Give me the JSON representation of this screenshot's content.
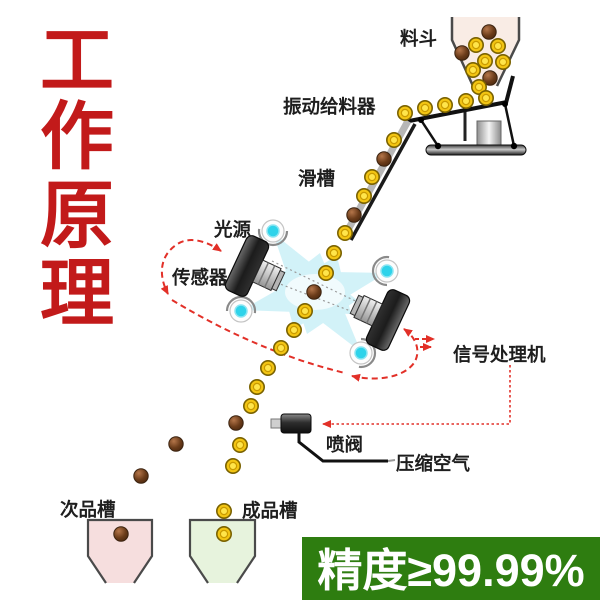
{
  "title": {
    "text": "工作原理",
    "chars": [
      "工",
      "作",
      "原",
      "理"
    ],
    "color": "#c21a1a"
  },
  "labels": {
    "hopper": "料斗",
    "feeder": "振动给料器",
    "chute": "滑槽",
    "light_source": "光源",
    "sensor": "传感器",
    "signal_processor": "信号处理机",
    "spray_valve": "喷阀",
    "compressed_air": "压缩空气",
    "reject_trough": "次品槽",
    "accept_trough": "成品槽"
  },
  "badge": {
    "text": "精度≥99.99%",
    "bg": "#2e7d10",
    "fg": "#ffffff"
  },
  "colors": {
    "accent_red": "#e23028",
    "title_red": "#c21a1a",
    "ball_yellow": "#f3c513",
    "ball_brown": "#6b3c1a",
    "beam_cyan": "#aee8f4",
    "hopper_fill": "#f9ece5",
    "reject_trough_fill": "#f6dede",
    "accept_trough_fill": "#e7f3dd"
  },
  "diagram": {
    "balls": [
      {
        "x": 489,
        "y": 32,
        "c": "b"
      },
      {
        "x": 476,
        "y": 45,
        "c": "y"
      },
      {
        "x": 498,
        "y": 46,
        "c": "y"
      },
      {
        "x": 462,
        "y": 53,
        "c": "b"
      },
      {
        "x": 485,
        "y": 61,
        "c": "y"
      },
      {
        "x": 503,
        "y": 62,
        "c": "y"
      },
      {
        "x": 473,
        "y": 70,
        "c": "y"
      },
      {
        "x": 490,
        "y": 78,
        "c": "b"
      },
      {
        "x": 479,
        "y": 87,
        "c": "y"
      },
      {
        "x": 486,
        "y": 98,
        "c": "y"
      },
      {
        "x": 466,
        "y": 101,
        "c": "y"
      },
      {
        "x": 445,
        "y": 105,
        "c": "y"
      },
      {
        "x": 425,
        "y": 108,
        "c": "y"
      },
      {
        "x": 405,
        "y": 113,
        "c": "y"
      },
      {
        "x": 394,
        "y": 140,
        "c": "y"
      },
      {
        "x": 384,
        "y": 159,
        "c": "b"
      },
      {
        "x": 372,
        "y": 177,
        "c": "y"
      },
      {
        "x": 364,
        "y": 196,
        "c": "y"
      },
      {
        "x": 354,
        "y": 215,
        "c": "b"
      },
      {
        "x": 345,
        "y": 233,
        "c": "y"
      },
      {
        "x": 334,
        "y": 253,
        "c": "y"
      },
      {
        "x": 326,
        "y": 273,
        "c": "y"
      },
      {
        "x": 314,
        "y": 292,
        "c": "b"
      },
      {
        "x": 305,
        "y": 311,
        "c": "y"
      },
      {
        "x": 294,
        "y": 330,
        "c": "y"
      },
      {
        "x": 281,
        "y": 348,
        "c": "y"
      },
      {
        "x": 268,
        "y": 368,
        "c": "y"
      },
      {
        "x": 257,
        "y": 387,
        "c": "y"
      },
      {
        "x": 251,
        "y": 406,
        "c": "y"
      },
      {
        "x": 240,
        "y": 445,
        "c": "y"
      },
      {
        "x": 233,
        "y": 466,
        "c": "y"
      },
      {
        "x": 224,
        "y": 511,
        "c": "y"
      },
      {
        "x": 224,
        "y": 534,
        "c": "y"
      },
      {
        "x": 236,
        "y": 423,
        "c": "b"
      },
      {
        "x": 176,
        "y": 444,
        "c": "b"
      },
      {
        "x": 141,
        "y": 476,
        "c": "b"
      },
      {
        "x": 121,
        "y": 534,
        "c": "b"
      }
    ]
  }
}
